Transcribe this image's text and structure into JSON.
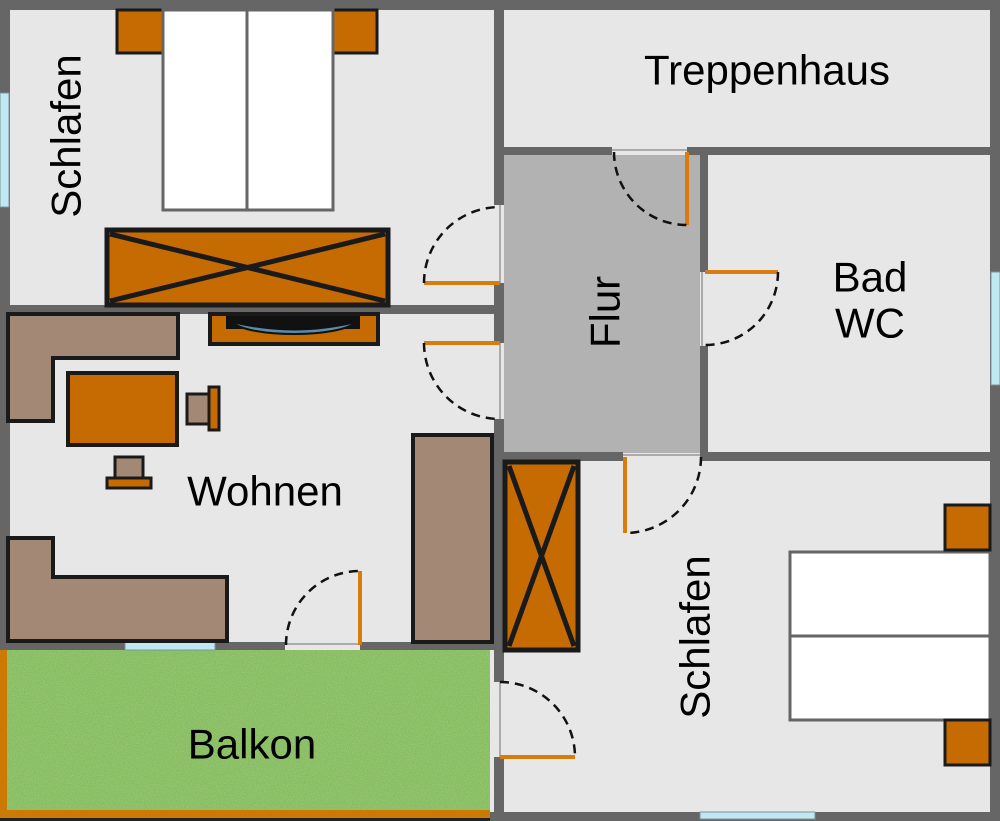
{
  "rooms": {
    "bedroom_top": {
      "label": "Schlafen"
    },
    "stairwell": {
      "label": "Treppenhaus"
    },
    "hallway": {
      "label": "Flur"
    },
    "bathroom": {
      "line1": "Bad",
      "line2": "WC"
    },
    "living_room": {
      "label": "Wohnen"
    },
    "balcony": {
      "label": "Balkon"
    },
    "bedroom_bottom": {
      "label": "Schlafen"
    }
  },
  "colors": {
    "wall": "#666666",
    "floor-light": "#e7e7e7",
    "floor-hall": "#b2b2b2",
    "orange": "#c66a02",
    "brown": "#a28875",
    "line": "#1a1a1a",
    "door": "#d97c0e",
    "window": "#bfe9f2",
    "grass": "#93ca6b",
    "railing": "#cc7a04",
    "tv": "#5b8cab",
    "label": "#000000"
  }
}
